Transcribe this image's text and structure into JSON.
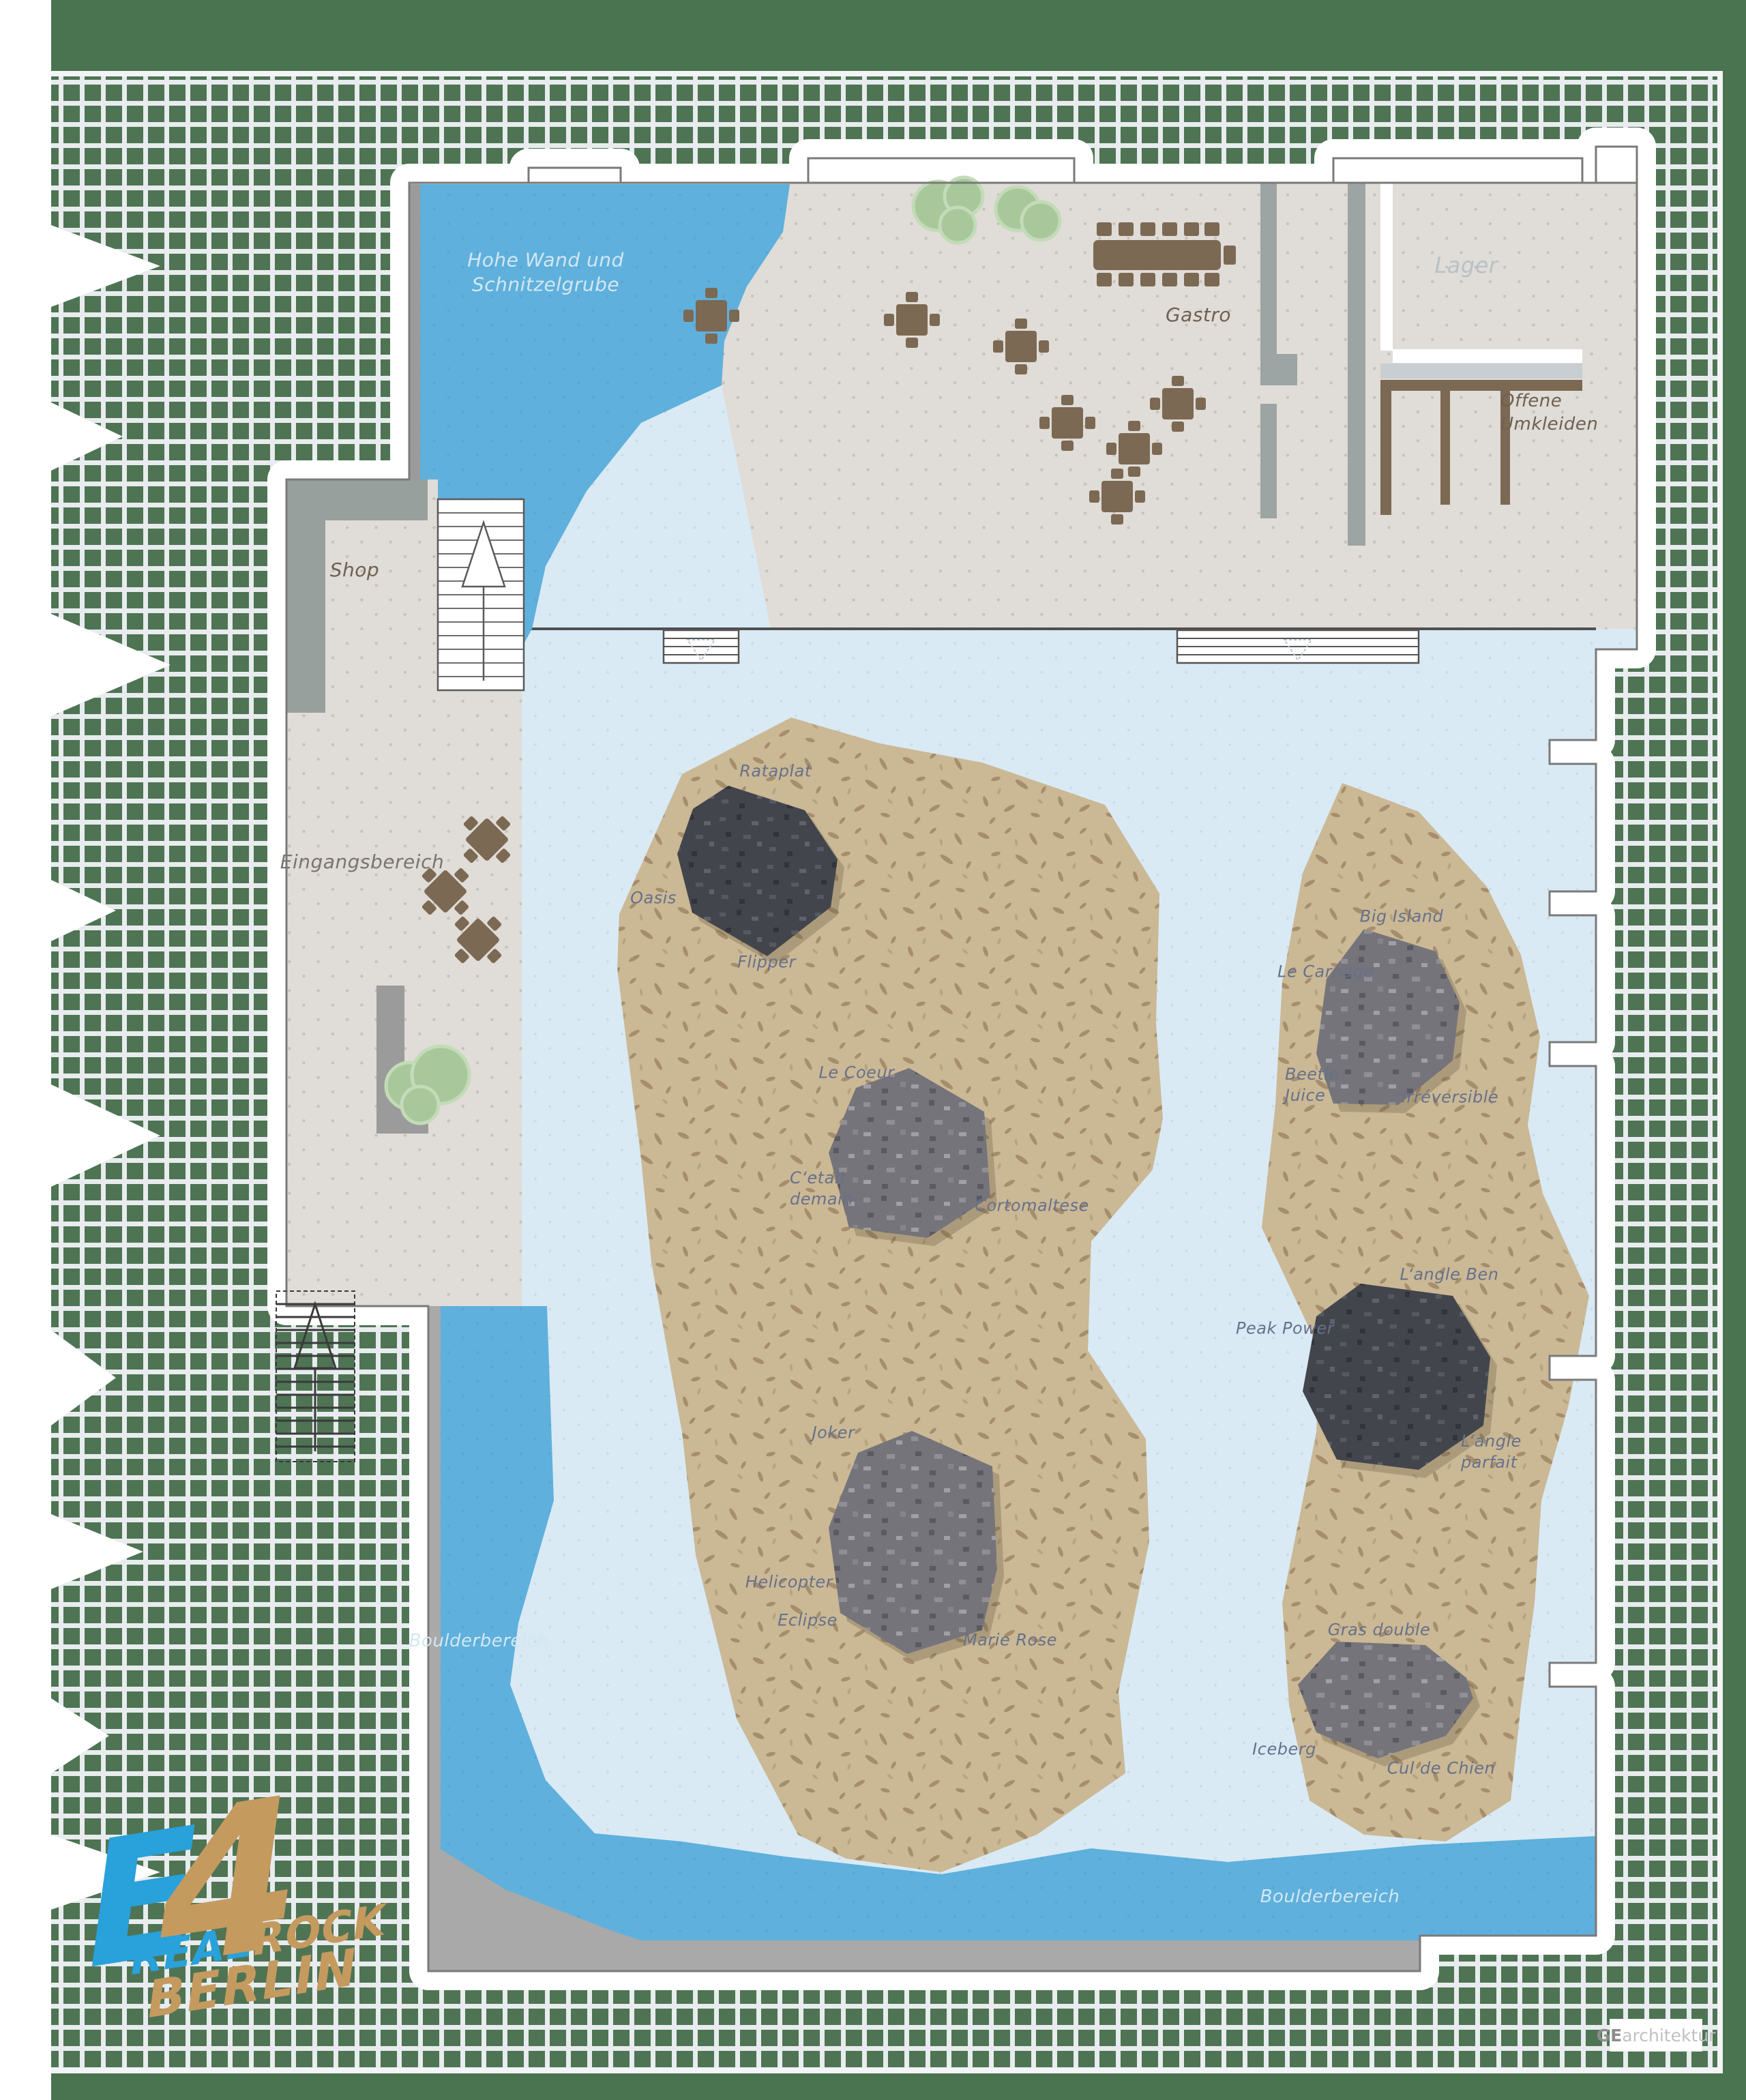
{
  "map": {
    "areas": {
      "hohe_wand": "Hohe Wand und\nSchnitzelgrube",
      "gastro": "Gastro",
      "lager": "Lager",
      "umkleiden": "Offene\nUmkleiden",
      "shop": "Shop",
      "eingangsbereich": "Eingangsbereich",
      "boulderbereich_left": "Boulderbereich",
      "boulderbereich_bottom": "Boulderbereich"
    },
    "boulders": {
      "rataplat": "Rataplat",
      "oasis": "Oasis",
      "flipper": "Flipper",
      "le_coeur": "Le Coeur",
      "cetait_demain": "C‘etait\ndemain",
      "cortomaltese": "Cortomaltese",
      "joker": "Joker",
      "helicopter": "Helicopter",
      "eclipse": "Eclipse",
      "marie_rose": "Marie Rose",
      "big_island": "Big Island",
      "le_carnage": "Le Carnage",
      "beetle_juice": "Beetle\nJuice",
      "irreversible": "Irréversible",
      "langle_ben": "L‘angle Ben",
      "peak_power": "Peak Power",
      "langle_parfait": "L‘angle\nparfait",
      "gras_double": "Gras double",
      "iceberg": "Iceberg",
      "cul_de_chien": "Cul de Chien"
    },
    "logo": {
      "e": "E",
      "four": "4",
      "real": "REAL",
      "rock": "ROCK",
      "berlin": "BERLIN"
    },
    "credit": {
      "bold": "GE",
      "light": "architektur"
    },
    "colors": {
      "site_green": "#4a7350",
      "tile_green": "#4e7454",
      "boulder_blue": "#5fb0dc",
      "pale_blue": "#d9eaf4",
      "sand": "#cbb895",
      "beige": "#e0dcd7",
      "furniture_brown": "#7c6953",
      "label_blue_gray": "#66718a",
      "logo_blue": "#29a1da",
      "logo_tan": "#c59a5f"
    }
  }
}
